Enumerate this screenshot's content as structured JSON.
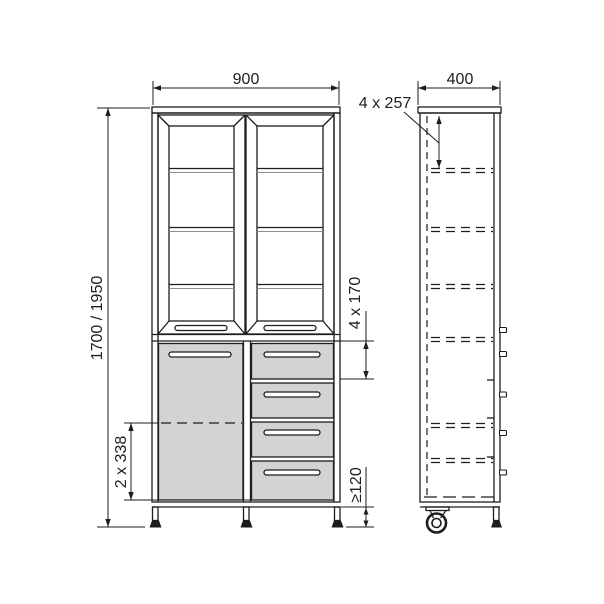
{
  "page": {
    "background": "#ffffff"
  },
  "drawing": {
    "type": "technical-drawing",
    "subject": "display cabinet, front and side orthographic views with dimensions",
    "colors": {
      "line": "#1d1d1d",
      "panel_fill": "#d3d3d3",
      "shelf_shadow": "#8f8f8f"
    },
    "front_view": {
      "width_mm": "900",
      "height_mm": "1700 / 1950",
      "drawer_spacing": "4 x 170",
      "door_shelf_spacing": "2 x 338",
      "ground_clearance": "≥120"
    },
    "side_view": {
      "depth_mm": "400",
      "shelf_spacing": "4 x 257"
    }
  }
}
